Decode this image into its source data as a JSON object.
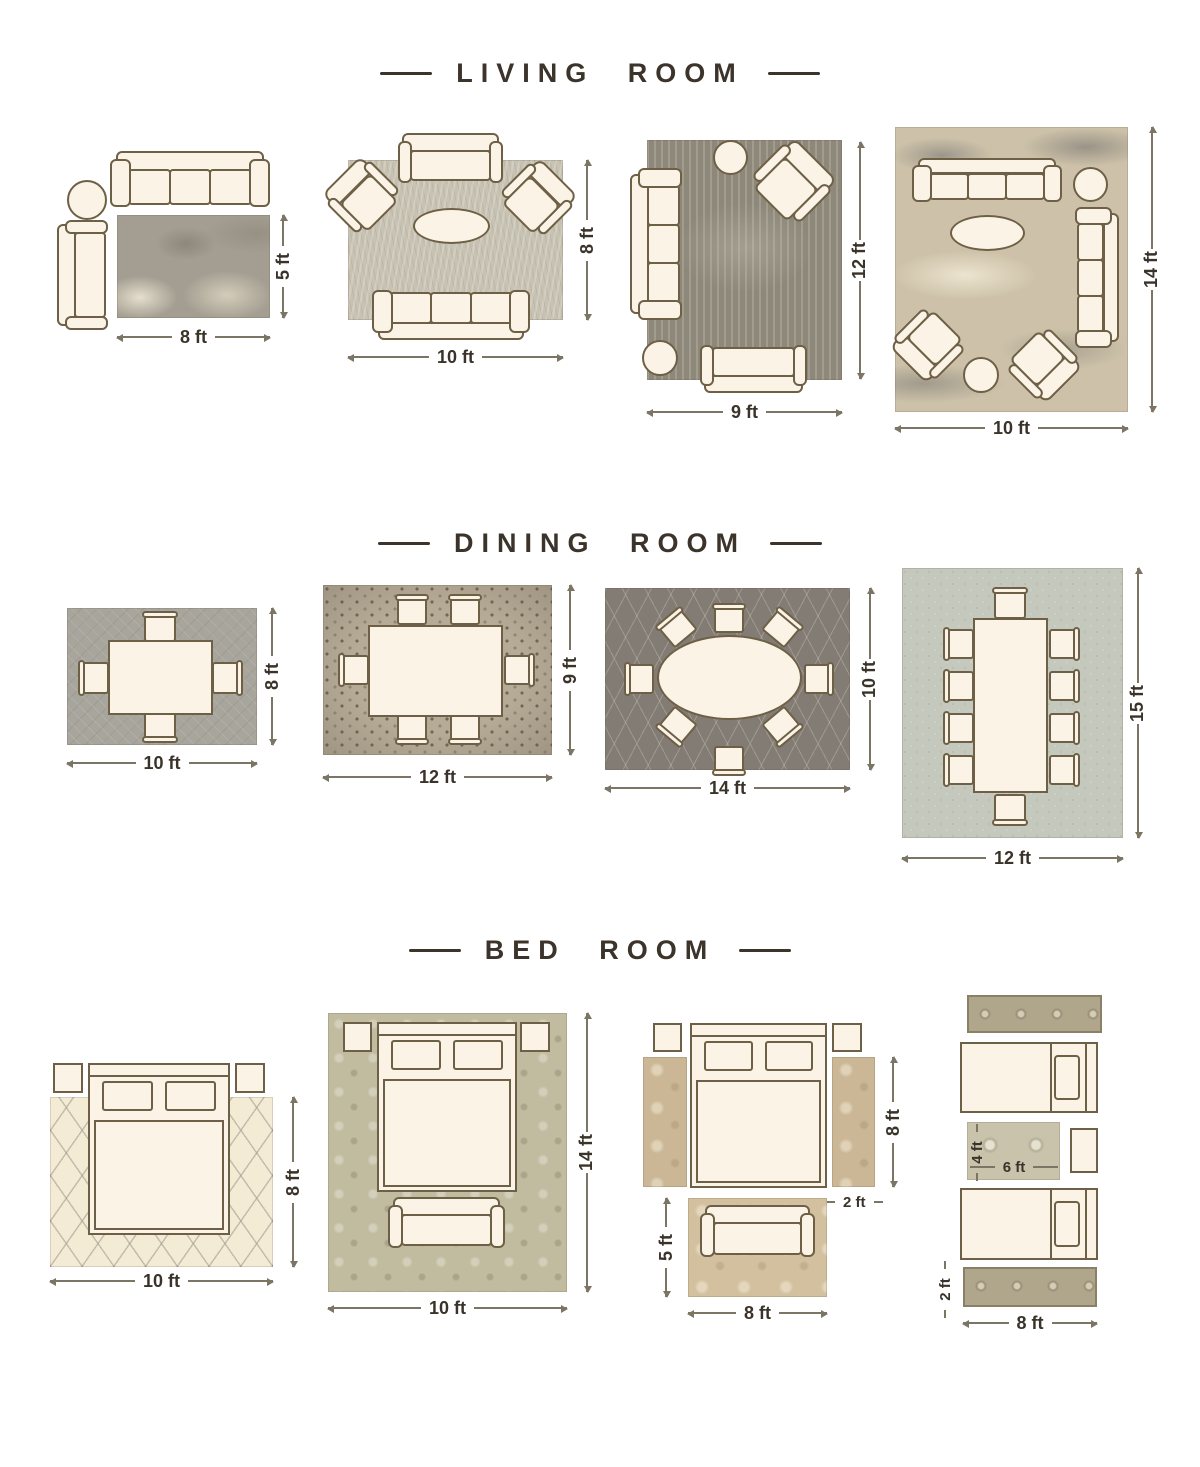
{
  "colors": {
    "bg": "#ffffff",
    "title": "#3c332a",
    "text": "#3a332a",
    "line": "#7c7465",
    "ff": "#fbf3e5",
    "fo": "#6e6046"
  },
  "rugs": {
    "lr1": "#a49e92",
    "lr2": "#c8c2b3",
    "lr3": "#8e887b",
    "lr4": "#cdc2a9",
    "dr1": "#a8a59d",
    "dr2": "#b5ab97",
    "dr3": "#837c74",
    "dr4": "#c5c8bd",
    "br1": "#f4ebd5",
    "br2": "#c1bca0",
    "br3_runner": "#cbb795",
    "br3_rug": "#d3c09e",
    "br4_runner": "#afa68b",
    "br4_rug": "#c9c3ac"
  },
  "living": {
    "title": "LIVING ROOM",
    "layouts": [
      {
        "w": "8 ft",
        "h": "5 ft"
      },
      {
        "w": "10 ft",
        "h": "8 ft"
      },
      {
        "w": "9 ft",
        "h": "12 ft"
      },
      {
        "w": "10 ft",
        "h": "14 ft"
      }
    ]
  },
  "dining": {
    "title": "DINING ROOM",
    "layouts": [
      {
        "w": "10 ft",
        "h": "8 ft"
      },
      {
        "w": "12 ft",
        "h": "9 ft"
      },
      {
        "w": "14 ft",
        "h": "10 ft"
      },
      {
        "w": "12 ft",
        "h": "15 ft"
      }
    ]
  },
  "bedroom": {
    "title": "BED ROOM",
    "layouts": [
      {
        "w": "10 ft",
        "h": "8 ft"
      },
      {
        "w": "10 ft",
        "h": "14 ft"
      },
      {
        "runner_h": "8 ft",
        "runner_w": "2 ft",
        "rug_h": "5 ft",
        "rug_w": "8 ft"
      },
      {
        "rug_h": "4 ft",
        "rug_w": "6 ft",
        "runner_w": "2 ft",
        "runner_l": "8 ft"
      }
    ]
  }
}
